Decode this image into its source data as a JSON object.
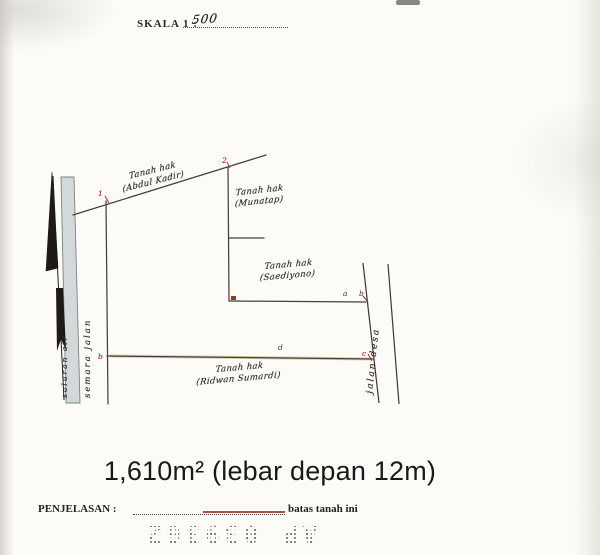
{
  "header": {
    "scale_label": "SKALA 1 :",
    "scale_value": "500"
  },
  "map": {
    "parcels": [
      {
        "line1": "Tanah hak",
        "line2": "(Abdul Kadir)"
      },
      {
        "line1": "Tanah hak",
        "line2": "(Munatap)"
      },
      {
        "line1": "Tanah hak",
        "line2": "(Saediyono)"
      },
      {
        "line1": "Tanah hak",
        "line2": "(Ridwan Sumardi)"
      }
    ],
    "left_channel_label": "saluran air",
    "left_road_label": "semara jalan",
    "right_road_label": "jalan desa",
    "marks": {
      "top_vertex": "2",
      "left_junction": "1",
      "mid_a": "a",
      "mid_b": "b",
      "bottom_d": "d",
      "bottom_right_c": "c",
      "bottom_left": "b"
    }
  },
  "area_note": "1,610m² (lebar depan 12m)",
  "footer": {
    "label": "PENJELASAN :",
    "note": "batas tanah ini"
  },
  "stamp": "AP 039362",
  "colors": {
    "boundary": "#45403a",
    "red_mark": "#a23425",
    "highlight": "#8a7420",
    "channel_fill": "#d3d8da"
  }
}
